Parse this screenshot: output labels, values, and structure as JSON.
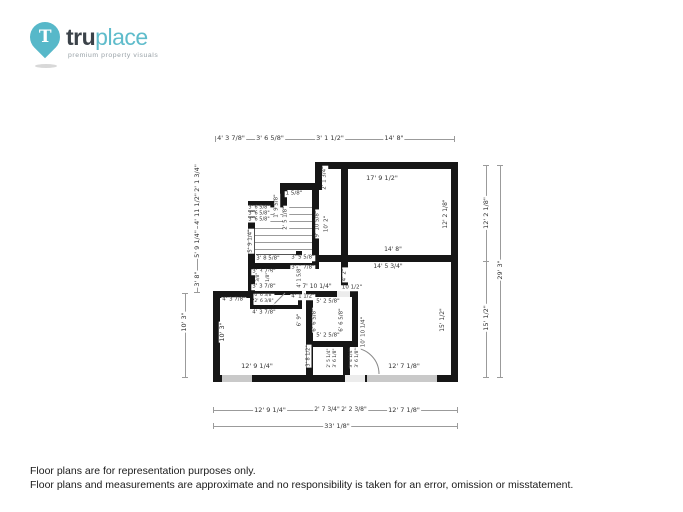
{
  "logo": {
    "pin_letter": "T",
    "brand_bold": "tru",
    "brand_light": "place",
    "tagline": "premium property visuals"
  },
  "colors": {
    "pin_teal": "#57b8c9",
    "brand_dark": "#3b4249",
    "tagline_gray": "#97a0a6",
    "wall_black": "#161616",
    "window_gray": "#c9c9c9"
  },
  "footer": {
    "line1": "Floor plans are for representation purposes only.",
    "line2": "Floor plans and measurements are approximate and no responsibility is taken for an error, omission or misstatement."
  },
  "floorplan": {
    "walls": [
      [
        315,
        162,
        143,
        7
      ],
      [
        451,
        162,
        7,
        220
      ],
      [
        213,
        375,
        245,
        7
      ],
      [
        213,
        291,
        7,
        91
      ],
      [
        213,
        291,
        44,
        7
      ],
      [
        248,
        201,
        7,
        97
      ],
      [
        248,
        201,
        39,
        7
      ],
      [
        280,
        187,
        7,
        21
      ],
      [
        280,
        183,
        42,
        7
      ],
      [
        315,
        162,
        7,
        28
      ],
      [
        312,
        190,
        7,
        79
      ],
      [
        341,
        162,
        7,
        100
      ],
      [
        312,
        255,
        146,
        7
      ],
      [
        248,
        263,
        71,
        6
      ],
      [
        250,
        291,
        52,
        4
      ],
      [
        250,
        305,
        52,
        4
      ],
      [
        250,
        291,
        4,
        18
      ],
      [
        298,
        291,
        4,
        18
      ],
      [
        306,
        291,
        7,
        84
      ],
      [
        306,
        291,
        52,
        6
      ],
      [
        352,
        291,
        6,
        56
      ],
      [
        306,
        341,
        52,
        6
      ],
      [
        343,
        347,
        7,
        28
      ],
      [
        341,
        262,
        7,
        29
      ]
    ],
    "windows": [
      [
        222,
        375,
        30,
        7
      ],
      [
        367,
        375,
        70,
        7
      ]
    ],
    "openings": [
      [
        345,
        375,
        20,
        7
      ],
      [
        337,
        291,
        13,
        6
      ]
    ],
    "dim_lines": [
      [
        215,
        139,
        240,
        1
      ],
      [
        213,
        410,
        245,
        1
      ],
      [
        213,
        426,
        245,
        1
      ],
      [
        197,
        165,
        1,
        128
      ],
      [
        185,
        293,
        1,
        85
      ],
      [
        486,
        165,
        1,
        213
      ],
      [
        500,
        165,
        1,
        213
      ]
    ],
    "ticks": [
      [
        215,
        136,
        1,
        6
      ],
      [
        454,
        136,
        1,
        6
      ],
      [
        213,
        407,
        1,
        6
      ],
      [
        457,
        407,
        1,
        6
      ],
      [
        213,
        423,
        1,
        6
      ],
      [
        457,
        423,
        1,
        6
      ],
      [
        194,
        165,
        6,
        1
      ],
      [
        194,
        292,
        6,
        1
      ],
      [
        182,
        293,
        6,
        1
      ],
      [
        182,
        377,
        6,
        1
      ],
      [
        483,
        165,
        6,
        1
      ],
      [
        483,
        261,
        6,
        1
      ],
      [
        483,
        377,
        6,
        1
      ],
      [
        497,
        165,
        6,
        1
      ],
      [
        497,
        377,
        6,
        1
      ]
    ],
    "treads": [
      [
        255,
        207,
        57
      ],
      [
        255,
        214,
        57
      ],
      [
        255,
        221,
        57
      ],
      [
        255,
        228,
        57
      ],
      [
        255,
        235,
        57
      ],
      [
        255,
        242,
        57
      ],
      [
        255,
        249,
        57
      ]
    ],
    "labels": [
      {
        "t": "4' 3 7/8\"",
        "x": 231,
        "y": 138,
        "r": 0,
        "s": 6.5
      },
      {
        "t": "3' 6 5/8\"",
        "x": 270,
        "y": 138,
        "r": 0,
        "s": 6.5
      },
      {
        "t": "3' 1 1/2\"",
        "x": 330,
        "y": 138,
        "r": 0,
        "s": 6.5
      },
      {
        "t": "14' 8\"",
        "x": 394,
        "y": 138,
        "r": 0,
        "s": 6.5
      },
      {
        "t": "12' 9 1/4\"",
        "x": 270,
        "y": 410,
        "r": 0,
        "s": 6.5
      },
      {
        "t": "2' 7 3/4\"",
        "x": 327,
        "y": 410,
        "r": 0,
        "s": 6
      },
      {
        "t": "2' 2 3/8\"",
        "x": 354,
        "y": 410,
        "r": 0,
        "s": 6
      },
      {
        "t": "12' 7 1/8\"",
        "x": 404,
        "y": 410,
        "r": 0,
        "s": 6.5
      },
      {
        "t": "33' 1/8\"",
        "x": 337,
        "y": 426,
        "r": 0,
        "s": 6.5
      },
      {
        "t": "2' 1 3/4\"",
        "x": 197,
        "y": 178,
        "r": 1,
        "s": 6.5
      },
      {
        "t": "4' 11 1/2\"",
        "x": 197,
        "y": 209,
        "r": 1,
        "s": 6.5
      },
      {
        "t": "5' 9 1/4\"",
        "x": 197,
        "y": 244,
        "r": 1,
        "s": 6.5
      },
      {
        "t": "3' 8\"",
        "x": 197,
        "y": 279,
        "r": 1,
        "s": 6.5
      },
      {
        "t": "10' 3\"",
        "x": 184,
        "y": 322,
        "r": 1,
        "s": 6.5
      },
      {
        "t": "12' 2 1/8\"",
        "x": 486,
        "y": 213,
        "r": 1,
        "s": 6.5
      },
      {
        "t": "15' 1/2\"",
        "x": 486,
        "y": 318,
        "r": 1,
        "s": 6.5
      },
      {
        "t": "29' 3\"",
        "x": 500,
        "y": 270,
        "r": 1,
        "s": 6.5
      },
      {
        "t": "17' 9 1/2\"",
        "x": 382,
        "y": 178,
        "r": 0,
        "s": 6.5
      },
      {
        "t": "12' 2 1/8\"",
        "x": 446,
        "y": 214,
        "r": 1,
        "s": 6
      },
      {
        "t": "14' 8\"",
        "x": 393,
        "y": 250,
        "r": 0,
        "s": 6
      },
      {
        "t": "14' 5 3/4\"",
        "x": 388,
        "y": 267,
        "r": 0,
        "s": 6
      },
      {
        "t": "15' 1/2\"",
        "x": 443,
        "y": 320,
        "r": 1,
        "s": 6
      },
      {
        "t": "12' 7 1/8\"",
        "x": 404,
        "y": 366,
        "r": 0,
        "s": 6.5
      },
      {
        "t": "10' 10 1/4\"",
        "x": 364,
        "y": 332,
        "r": 1,
        "s": 5.5
      },
      {
        "t": "4' 2\"",
        "x": 345,
        "y": 275,
        "r": 1,
        "s": 5.5
      },
      {
        "t": "10' 3\"",
        "x": 222,
        "y": 332,
        "r": 1,
        "s": 6.5
      },
      {
        "t": "12' 9 1/4\"",
        "x": 257,
        "y": 366,
        "r": 0,
        "s": 6.5
      },
      {
        "t": "2' 1 3/4\"",
        "x": 325,
        "y": 178,
        "r": 1,
        "s": 5.5
      },
      {
        "t": "9' 10 5/8\"",
        "x": 318,
        "y": 224,
        "r": 1,
        "s": 5.5
      },
      {
        "t": "10' 2\"",
        "x": 327,
        "y": 224,
        "r": 1,
        "s": 5.5
      },
      {
        "t": "1 5/8\"",
        "x": 294,
        "y": 194,
        "r": 0,
        "s": 5.5
      },
      {
        "t": "1' 9 5/8\"",
        "x": 277,
        "y": 206,
        "r": 1,
        "s": 5.5
      },
      {
        "t": "2' 5 1/8\"",
        "x": 286,
        "y": 218,
        "r": 1,
        "s": 5.5
      },
      {
        "t": "3' 6 5/8\"",
        "x": 259,
        "y": 208,
        "r": 0,
        "s": 5
      },
      {
        "t": "3' 6 5/8\"",
        "x": 259,
        "y": 214,
        "r": 0,
        "s": 5
      },
      {
        "t": "3' 6 5/8\"",
        "x": 259,
        "y": 220,
        "r": 0,
        "s": 5
      },
      {
        "t": "3' 5 5/8\"",
        "x": 303,
        "y": 258,
        "r": 0,
        "s": 5.5
      },
      {
        "t": "3' 4 7/8\"",
        "x": 303,
        "y": 268,
        "r": 0,
        "s": 5.5
      },
      {
        "t": "7' 10 1/4\"",
        "x": 317,
        "y": 287,
        "r": 0,
        "s": 6
      },
      {
        "t": "4' 1 1/2\"",
        "x": 303,
        "y": 297,
        "r": 0,
        "s": 5.5
      },
      {
        "t": "10 1/2\"",
        "x": 352,
        "y": 288,
        "r": 0,
        "s": 5.5
      },
      {
        "t": "5' 9 1/4\"",
        "x": 251,
        "y": 241,
        "r": 1,
        "s": 5.5
      },
      {
        "t": "3' 8 5/8\"",
        "x": 268,
        "y": 259,
        "r": 0,
        "s": 5.5
      },
      {
        "t": "3' 3 7/8\"",
        "x": 264,
        "y": 272,
        "r": 0,
        "s": 5.5
      },
      {
        "t": "2' 3/8\"",
        "x": 259,
        "y": 280,
        "r": 1,
        "s": 4.5
      },
      {
        "t": "2' 1/8\"",
        "x": 269,
        "y": 280,
        "r": 1,
        "s": 4.5
      },
      {
        "t": "4' 1 5/8\"",
        "x": 300,
        "y": 277,
        "r": 1,
        "s": 5
      },
      {
        "t": "3' 3 7/8\"",
        "x": 264,
        "y": 287,
        "r": 0,
        "s": 5.5
      },
      {
        "t": "0' 6 3/8\"",
        "x": 264,
        "y": 296,
        "r": 0,
        "s": 4.5
      },
      {
        "t": "2' 6 3/8\"",
        "x": 264,
        "y": 302,
        "r": 0,
        "s": 4.5
      },
      {
        "t": "4' 3 7/8\"",
        "x": 264,
        "y": 313,
        "r": 0,
        "s": 5.5
      },
      {
        "t": "4' 3 7/8\"",
        "x": 234,
        "y": 300,
        "r": 0,
        "s": 5.5
      },
      {
        "t": "6' 6 5/8\"",
        "x": 315,
        "y": 320,
        "r": 1,
        "s": 5.5
      },
      {
        "t": "6' 6 5/8\"",
        "x": 342,
        "y": 320,
        "r": 1,
        "s": 5.5
      },
      {
        "t": "5' 2 5/8\"",
        "x": 328,
        "y": 302,
        "r": 0,
        "s": 5.5
      },
      {
        "t": "5' 2 5/8\"",
        "x": 328,
        "y": 336,
        "r": 0,
        "s": 5.5
      },
      {
        "t": "6' 9\"",
        "x": 300,
        "y": 320,
        "r": 1,
        "s": 5.5
      },
      {
        "t": "3' 8 1/2\"",
        "x": 309,
        "y": 356,
        "r": 1,
        "s": 5
      },
      {
        "t": "2' 5 1/4\"",
        "x": 330,
        "y": 358,
        "r": 1,
        "s": 4.5
      },
      {
        "t": "3' 6 1/8\"",
        "x": 336,
        "y": 358,
        "r": 1,
        "s": 4.5
      },
      {
        "t": "3' 4 1/4\"",
        "x": 352,
        "y": 358,
        "r": 1,
        "s": 4.5
      },
      {
        "t": "3' 6 1/8\"",
        "x": 358,
        "y": 358,
        "r": 1,
        "s": 4.5
      }
    ]
  }
}
